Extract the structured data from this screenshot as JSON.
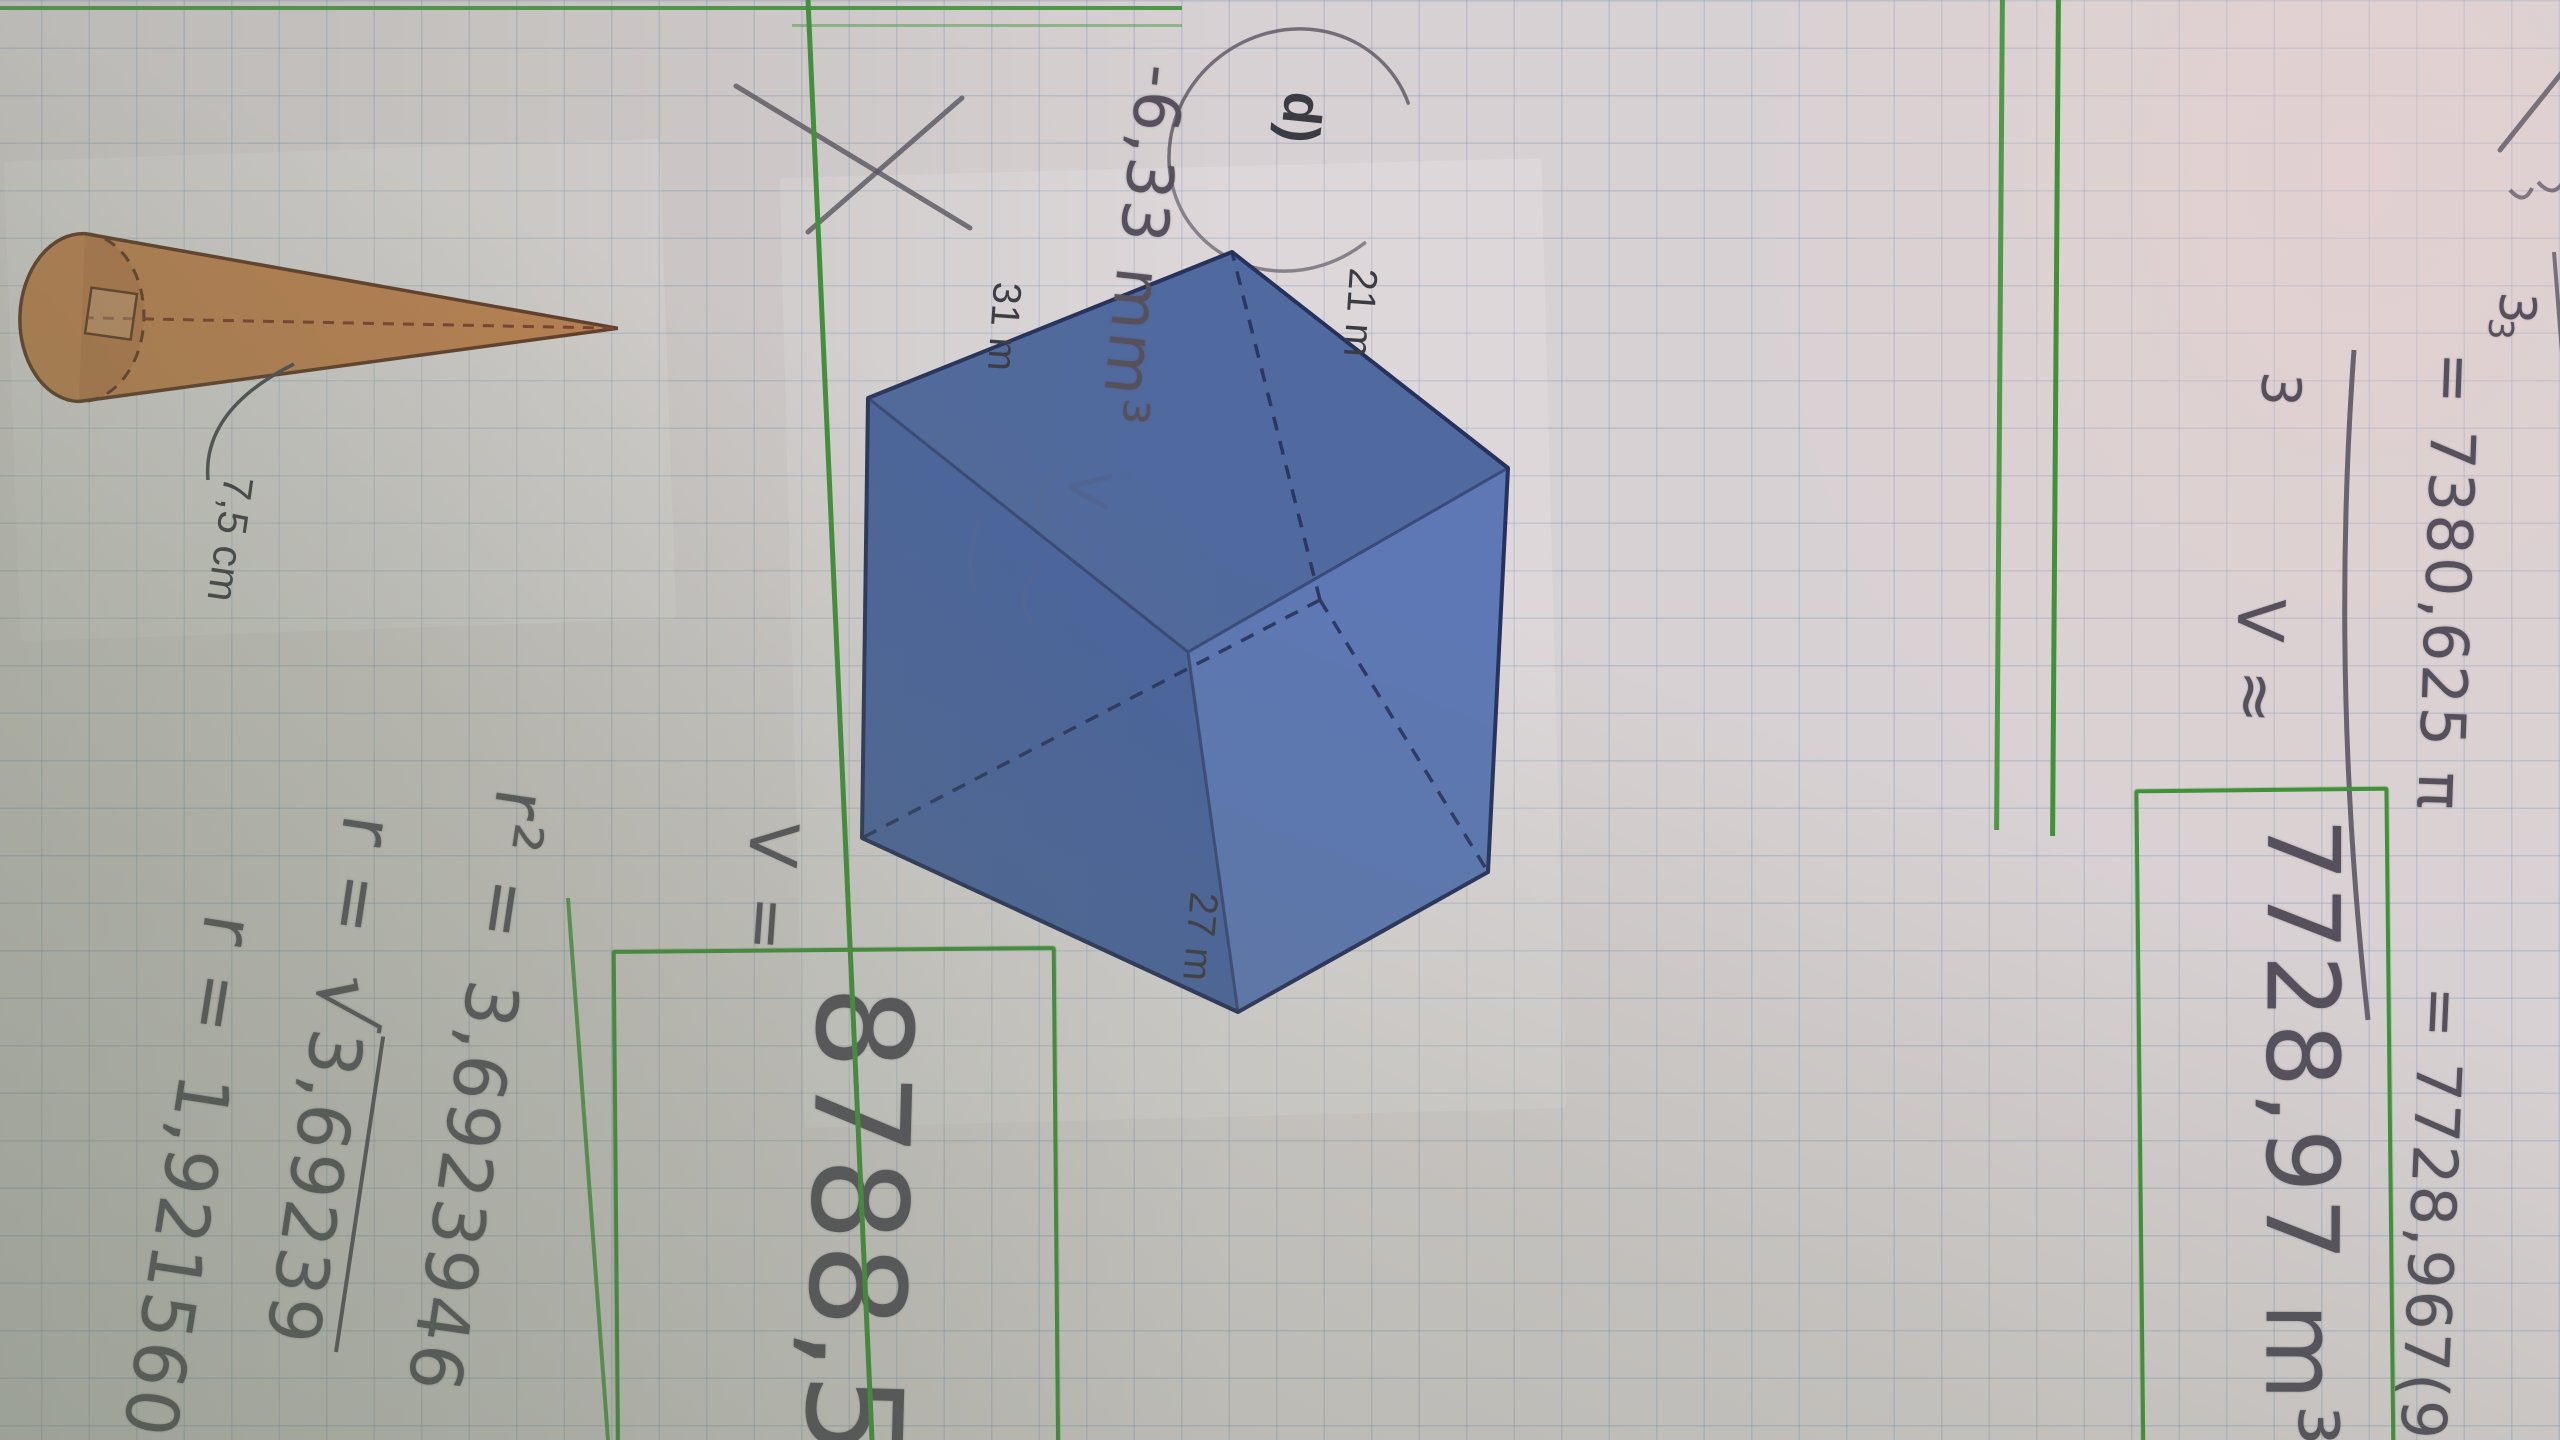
{
  "colors": {
    "paper": "#d8d1d3",
    "grid_line": "#7a94b4",
    "green_pen": "#3f9238",
    "pencil": "#55505c",
    "print_text": "#3b3b44",
    "prism_face_light": "#5d78b5",
    "prism_face_mid": "#50699f",
    "prism_face_dark": "#4a64a0",
    "prism_outline": "#27325c",
    "cone_fill": "#c28150",
    "cone_outline": "#5f3722",
    "cone_axis": "#7c3a28"
  },
  "top_section": {
    "fragment_exponent": "3",
    "fragment_denominator": "3",
    "fraction_numerator": "= 7380,625 π",
    "fraction_denominator": "3",
    "continuation": "= 7728,967(98",
    "approx_label": "V ≈",
    "boxed_answer": "7728,97 m³"
  },
  "prism_problem": {
    "label": "d)",
    "dim_top": "21 m",
    "dim_right": "27 m",
    "dim_left": "31 m",
    "rejected_answer": "-6,33 mm³",
    "erased_mark": "V",
    "result_label": "V =",
    "boxed_answer": "8788,5 m³"
  },
  "cone_problem": {
    "dim_label": "7,5 cm",
    "line1_lhs": "r² =",
    "line1_rhs": "3,6923946",
    "line2_lhs": "r =",
    "line2_radical": "√",
    "line2_radicand": "3,69239",
    "line3_lhs": "r =",
    "line3_rhs": "1,921560"
  }
}
